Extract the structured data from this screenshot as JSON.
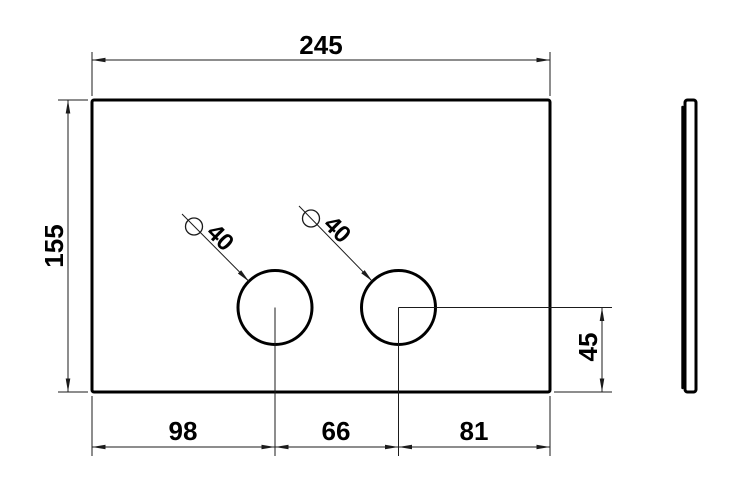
{
  "drawing": {
    "part": {
      "plate_width_mm": 245,
      "plate_height_mm": 155,
      "hole_diameter_mm": 40,
      "hole_left_offset_mm": 98,
      "hole_spacing_mm": 66,
      "hole_right_offset_mm": 81,
      "hole_center_from_bottom_mm": 45
    },
    "labels": {
      "width": "245",
      "height": "155",
      "span_left": "98",
      "span_middle": "66",
      "span_right": "81",
      "hole_height": "45",
      "hole_left_diameter": "40",
      "hole_right_diameter": "40"
    },
    "colors": {
      "object_line": "#000000",
      "dimension_line": "#1b1b1b",
      "background": "#ffffff"
    }
  }
}
